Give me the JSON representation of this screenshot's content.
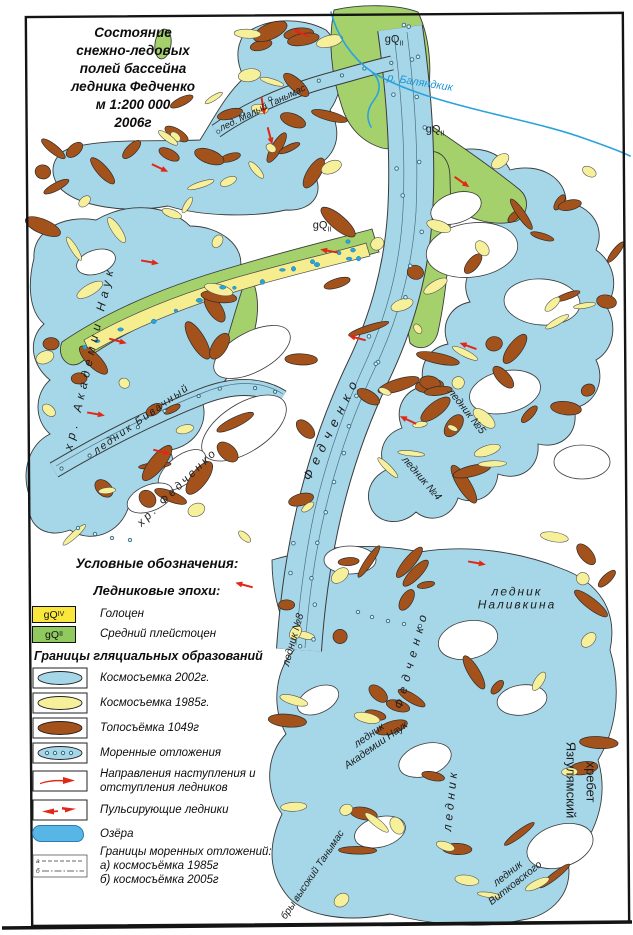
{
  "title": {
    "text": "Состояние\nснежно-ледовых\nполей бассейна\nледника Федченко\nм 1:200 000\n2006г"
  },
  "legend": {
    "heading": "Условные обозначения:",
    "epochs_heading": "Ледниковые эпохи:",
    "epochs": [
      {
        "code": "gQ",
        "sub": "IV",
        "label": "Голоцен"
      },
      {
        "code": "gQ",
        "sub": "II",
        "label": "Средний плейстоцен"
      }
    ],
    "boundaries_heading": "Границы гляциальных образований",
    "items": [
      {
        "label": "Космосъемка 2002г."
      },
      {
        "label": "Космосъемка 1985г."
      },
      {
        "label": "Топосъёмка 1049г"
      },
      {
        "label": "Моренные отложения"
      },
      {
        "label": "Направления наступления и отступления ледников"
      },
      {
        "label": "Пульсирующие ледники"
      },
      {
        "label": "Озёра"
      },
      {
        "label": "Границы моренных отложений:",
        "line_a": "а) космосъёмка 1985г",
        "line_b": "б) космосъёмка 2005г",
        "mark_a": "а",
        "mark_b": "б"
      }
    ]
  },
  "map": {
    "labels": [
      {
        "id": "gq-top",
        "base": "gQ",
        "sub": "II",
        "x": 394,
        "y": 41,
        "rot": 0,
        "fs": 11
      },
      {
        "id": "gq-right",
        "base": "gQ",
        "sub": "II",
        "x": 435,
        "y": 131,
        "rot": 0,
        "fs": 11
      },
      {
        "id": "gq-mid",
        "base": "gQ",
        "sub": "II",
        "x": 322,
        "y": 227,
        "rot": 0,
        "fs": 11
      },
      {
        "id": "river-balyandkik",
        "text": "р. Баляндкик",
        "x": 420,
        "y": 83,
        "rot": 9,
        "fs": 11,
        "color": "#1b96d4"
      },
      {
        "id": "maly-tanymas",
        "text": "лед. Малый Танымас",
        "x": 263,
        "y": 109,
        "rot": -26,
        "fs": 9.5
      },
      {
        "id": "akademii-ridge",
        "text": "хр. Академии Наук",
        "x": 90,
        "y": 358,
        "rot": -77,
        "fs": 12,
        "sp": 5
      },
      {
        "id": "bivachny",
        "text": "ледник Бивачный",
        "x": 142,
        "y": 420,
        "rot": -35,
        "fs": 10.5,
        "sp": 2
      },
      {
        "id": "fedchenko-ridge",
        "text": "хр. Федченко",
        "x": 178,
        "y": 488,
        "rot": -44,
        "fs": 11.5,
        "sp": 3
      },
      {
        "id": "fedchenko-upper",
        "text": "Федченко",
        "x": 332,
        "y": 428,
        "rot": -64,
        "fs": 13,
        "sp": 7
      },
      {
        "id": "glacier-no5",
        "text": "ледник №5",
        "x": 466,
        "y": 412,
        "rot": 52,
        "fs": 10.5
      },
      {
        "id": "glacier-no4",
        "text": "ледник №4",
        "x": 421,
        "y": 479,
        "rot": 49,
        "fs": 10.5
      },
      {
        "id": "nalivkina",
        "text": "ледник Наливкина",
        "x": 517,
        "y": 599,
        "rot": 0,
        "fs": 12,
        "sp": 2
      },
      {
        "id": "glacier-no8",
        "text": "ледник №8",
        "x": 294,
        "y": 640,
        "rot": -74,
        "fs": 10.5
      },
      {
        "id": "fedchenko-lower",
        "text": "Федченко",
        "x": 412,
        "y": 659,
        "rot": -75,
        "fs": 12,
        "sp": 6
      },
      {
        "id": "akademii-glacier",
        "text": "ледник\nАкадемии Наук",
        "x": 373,
        "y": 741,
        "rot": -35,
        "fs": 10.5
      },
      {
        "id": "lednik-lower",
        "text": "ледник",
        "x": 451,
        "y": 800,
        "rot": -84,
        "fs": 12,
        "sp": 4
      },
      {
        "id": "vitkovskogo",
        "text": "ледник\nВитковского",
        "x": 512,
        "y": 879,
        "rot": -38,
        "fs": 10.5
      },
      {
        "id": "yazgulyam-1",
        "text": "Язгулямский",
        "x": 570,
        "y": 780,
        "rot": 90,
        "fs": 13,
        "it": false
      },
      {
        "id": "yazgulyam-2",
        "text": "хребет",
        "x": 590,
        "y": 782,
        "rot": 90,
        "fs": 13,
        "it": false
      },
      {
        "id": "vysoky-tanymas",
        "text": "бры высокий Танымас",
        "x": 313,
        "y": 875,
        "rot": -56,
        "fs": 10
      }
    ]
  },
  "colors": {
    "ice_blue": "#a6d7e9",
    "pleistocene_green": "#a4d16c",
    "holocene_band_yellow": "#f6ee8e",
    "yellow_patch": "#f7f09a",
    "brown_patch": "#a4521c",
    "legend_yellow": "#f9e73e",
    "legend_green": "#90ca5e",
    "river_blue": "#2aa3dd",
    "arrow_red": "#e02818"
  }
}
